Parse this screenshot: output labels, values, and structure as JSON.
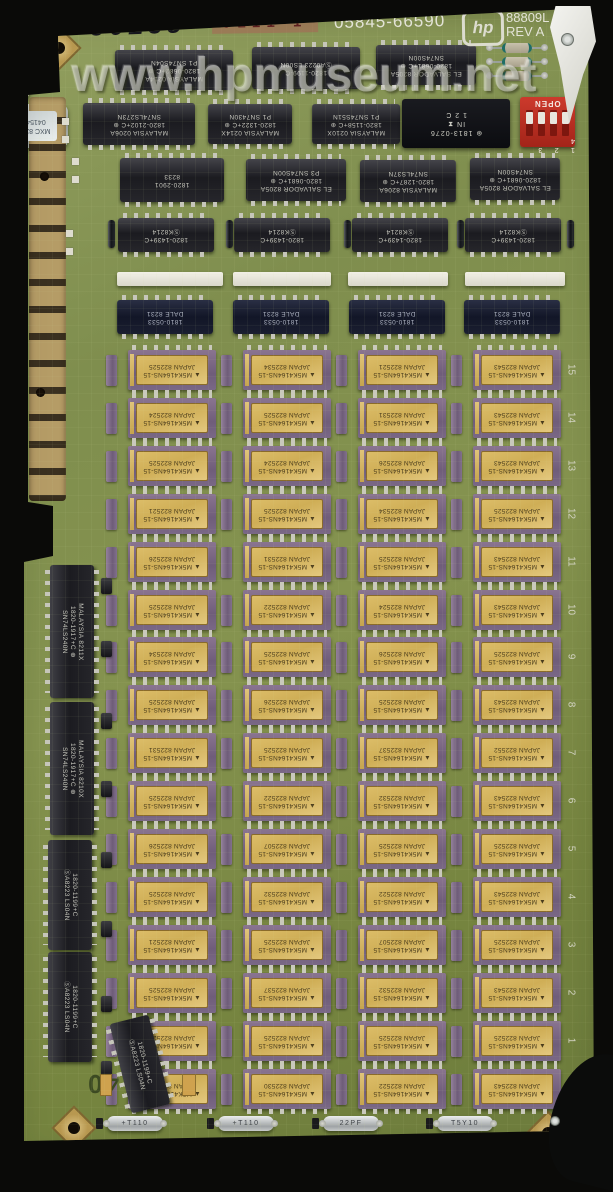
{
  "watermark": "www.hpmuseum.net",
  "top_markings": {
    "handwritten": "36L35",
    "stamp": "0111 1",
    "part_number": "05845-66590",
    "hp_logo": "hp",
    "serial": "88809L",
    "rev": "REV A"
  },
  "slot_marking": "40",
  "left_sticker": "P14136",
  "dip_switch": {
    "open_label": "OPEN",
    "numbers": "1 2 3 4"
  },
  "chips": {
    "a1": [
      "MALAYSIA 0214A",
      "1820-0682+C ⊕",
      "P1  SN74S04N"
    ],
    "a2": [
      "1820-1199-C",
      "ⓈA0223  LS00N"
    ],
    "a3": [
      "EL SALVADOR 8205A",
      "1820-0681+C ⊕",
      "SN74S00N"
    ],
    "b1": [
      "MALAYSIA 0206A",
      "1820-2102+C ⊕",
      "SN74LS273N"
    ],
    "b2": [
      "MALAYSIA 0214X",
      "1820-1322+C ⊕",
      "P1  SN7430N"
    ],
    "b3": [
      "MALAYSIA 0210X",
      "1820-1158+C ⊕",
      "P1  SN74S51N"
    ],
    "module": [
      "V",
      "⊛ 1813-0276",
      "IN ⧗",
      "1   2   C"
    ],
    "c1": [
      "1820-2901",
      "8233"
    ],
    "c2": [
      "EL SALVADOR 8205A",
      "1820-0681+C ⊕",
      "P3  SN74S00N"
    ],
    "c3": [
      "MALAYSIA 8206A",
      "1820-1287+C ⊕",
      "SN74LS37N"
    ],
    "c4": [
      "EL SALVADOR 8205A",
      "1820-0681+C ⊕",
      "SN74S00N"
    ],
    "d_row": [
      "1820-1439+C",
      "ⓈK8214"
    ],
    "e_row": [
      "1810-0533",
      "DALE 8231"
    ],
    "l1": [
      "MALAYSIA 8211X",
      "1820-1917+C ⊕",
      "SN74LS240N"
    ],
    "l2": [
      "MALAYSIA 8210X",
      "1820-1917+C ⊕",
      "SN74LS240N"
    ],
    "l3": [
      "1820-1199+C",
      "ⓈA8223  LS04N"
    ],
    "l4": [
      "1820-1199+C",
      "ⓈA8223  LS04N"
    ],
    "l5": [
      "1820-1199+C",
      "ⓈA8223  LS04N"
    ]
  },
  "ram": {
    "brand_mark": "▲",
    "part": "M5K4164NS-15",
    "origin": "JAPAN",
    "rows": [
      {
        "num": "15",
        "codes": [
          "822525",
          "822534",
          "822521",
          "822543"
        ]
      },
      {
        "num": "14",
        "codes": [
          "822524",
          "822525",
          "822531",
          "822543"
        ]
      },
      {
        "num": "13",
        "codes": [
          "822525",
          "822524",
          "822526",
          "822543"
        ]
      },
      {
        "num": "12",
        "codes": [
          "822521",
          "822525",
          "822534",
          "822525"
        ]
      },
      {
        "num": "11",
        "codes": [
          "822526",
          "822531",
          "822525",
          "822543"
        ]
      },
      {
        "num": "10",
        "codes": [
          "822525",
          "822522",
          "822524",
          "822543"
        ]
      },
      {
        "num": "9",
        "codes": [
          "822534",
          "822525",
          "822526",
          "822525"
        ]
      },
      {
        "num": "8",
        "codes": [
          "822525",
          "822526",
          "822525",
          "822543"
        ]
      },
      {
        "num": "7",
        "codes": [
          "822531",
          "822525",
          "822537",
          "822552"
        ]
      },
      {
        "num": "6",
        "codes": [
          "822525",
          "822522",
          "822532",
          "822543"
        ]
      },
      {
        "num": "5",
        "codes": [
          "822526",
          "822507",
          "822525",
          "822525"
        ]
      },
      {
        "num": "4",
        "codes": [
          "822525",
          "822532",
          "822522",
          "822543"
        ]
      },
      {
        "num": "3",
        "codes": [
          "822521",
          "822525",
          "822507",
          "822525"
        ]
      },
      {
        "num": "2",
        "codes": [
          "822525",
          "822537",
          "822532",
          "822543"
        ]
      },
      {
        "num": "1",
        "codes": [
          "822527",
          "822525",
          "822525",
          "822525"
        ]
      },
      {
        "num": "0",
        "codes": [
          "822525",
          "822530",
          "822522",
          "822543"
        ]
      }
    ]
  },
  "crystal": [
    "MXC 8222",
    "041540"
  ],
  "delay_lines": [
    "+T110",
    "+T110",
    "22PF",
    "T5Y10"
  ],
  "colors": {
    "board_green": "#7f8e4e",
    "ram_purple": "#7a6886",
    "ram_lid_gold": "#d4b45e",
    "dip_switch_red": "#c03028",
    "gold_finger": "#b59c66"
  }
}
